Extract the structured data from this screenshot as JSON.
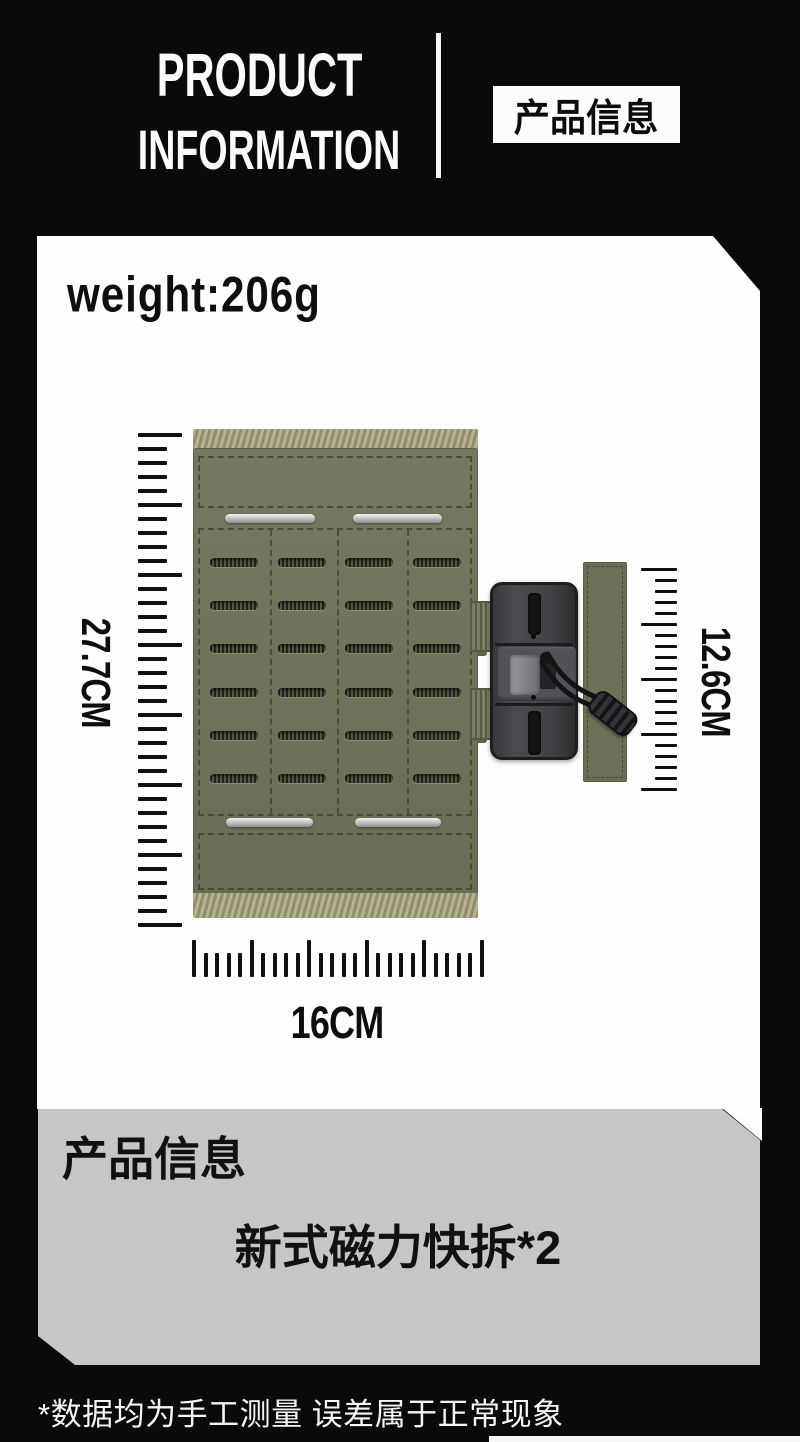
{
  "header": {
    "title_line1": "PRODUCT",
    "title_line2": "INFORMATION",
    "badge": "产品信息"
  },
  "spec_panel": {
    "weight": "weight:206g",
    "measurements": {
      "height": "27.7CM",
      "buckle_height": "12.6CM",
      "width": "16CM"
    },
    "rulers": {
      "left": {
        "ticks": 36,
        "major_every": 5
      },
      "right": {
        "ticks": 21,
        "major_every": 5
      },
      "bottom": {
        "ticks": 26,
        "major_every": 5
      }
    },
    "product": {
      "name": "laser-cut molle panel with magnetic quick-release buckle",
      "grid": {
        "rows": 6,
        "cols": 4
      }
    }
  },
  "info_panel": {
    "heading": "产品信息",
    "description": "新式磁力快拆*2"
  },
  "footer": {
    "note": "*数据均为手工测量 误差属于正常现象"
  },
  "colors": {
    "background": "#0a0a0a",
    "panel_white": "#fdfdfd",
    "panel_gray": "#c6c6c6",
    "olive": "#70735a",
    "webbing": "#a5a27b",
    "strap": "#6b7053",
    "buckle": "#3e3f42",
    "ink": "#101010"
  }
}
